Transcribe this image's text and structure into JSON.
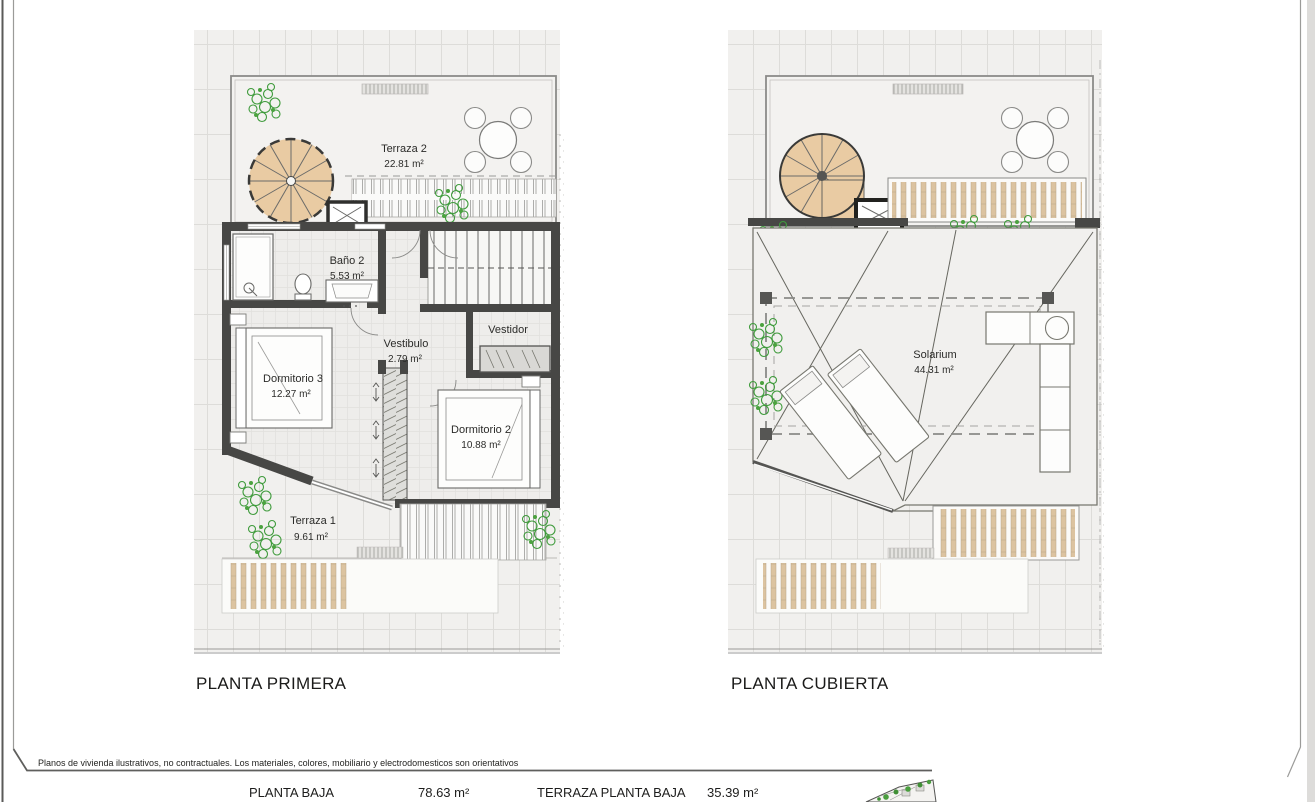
{
  "footer": {
    "disclaimer": "Planos de vivienda ilustrativos, no contractuales. Los materiales, colores, mobiliario y electrodomesticos son orientativos"
  },
  "plan_left": {
    "title": "PLANTA PRIMERA",
    "rooms": {
      "terraza2": {
        "name": "Terraza 2",
        "area": "22.81 m²"
      },
      "bano2": {
        "name": "Baño 2",
        "area": "5.53 m²"
      },
      "vestibulo": {
        "name": "Vestibulo",
        "area": "2.79 m²"
      },
      "vestidor": {
        "name": "Vestidor"
      },
      "dormitorio3": {
        "name": "Dormitorio 3",
        "area": "12.27 m²"
      },
      "dormitorio2": {
        "name": "Dormitorio 2",
        "area": "10.88 m²"
      },
      "terraza1": {
        "name": "Terraza 1",
        "area": "9.61 m²"
      }
    }
  },
  "plan_right": {
    "title": "PLANTA CUBIERTA",
    "rooms": {
      "solarium": {
        "name": "Solarium",
        "area": "44.31 m²"
      }
    }
  },
  "areas_table": {
    "row1": {
      "label1": "PLANTA BAJA",
      "value1": "78.63 m²",
      "label2": "TERRAZA PLANTA BAJA",
      "value2": "35.39 m²"
    },
    "row2": {
      "label1": "PLANTA PRIMERA",
      "value1": "49.51 m²",
      "label2": "TERRAZA PLANTA PRIMERA 1 y 2",
      "value2": "32.42 m²"
    }
  },
  "colors": {
    "wall": "#474745",
    "stair_tan": "#e9cba3",
    "slat_tan": "#dcc3a0",
    "plant_green": "#3f9b3c",
    "ground_tile": "#f1f0ee",
    "line_gray": "#8a8a88"
  }
}
